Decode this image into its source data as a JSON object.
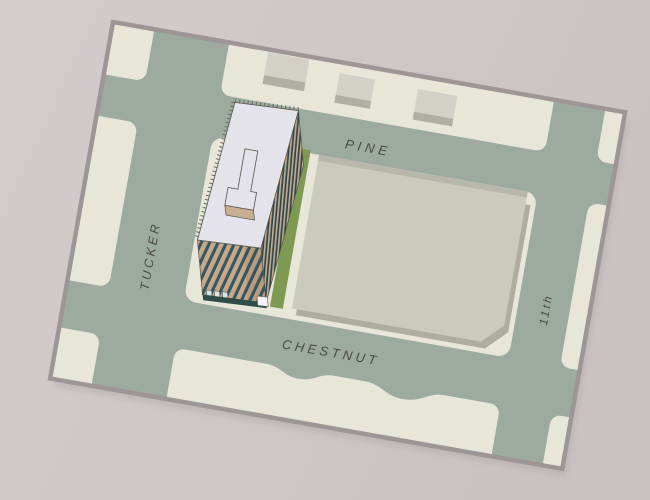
{
  "scene": {
    "kind": "architectural-site-plan",
    "rotation_deg": 10
  },
  "labels": {
    "pine": "PINE",
    "tucker": "TUCKER",
    "chestnut": "CHESTNUT",
    "eleventh": "11th"
  },
  "colors": {
    "background": "#cfc7c7",
    "site_border": "#9d9596",
    "site_shadow": "#b3a9a9",
    "street": "#9caa9f",
    "block": "#e8e6d9",
    "lot": "#cccabd",
    "lot_edge": "#b9b7ac",
    "lot_shadow": "#afada2",
    "small_building_roof": "#d3d1c7",
    "small_building_face": "#b1afa4",
    "grass": "#7e9a52",
    "tower_roof": "#e3e3e9",
    "outline": "#55544c",
    "hatch": "#6a6a60",
    "facade_tan": "#c4aa8d",
    "window_teal": "#39565c",
    "window_teal_dark": "#2b464c",
    "base_teal": "#2e4d49",
    "canopy_white": "#dde3e4",
    "box_white": "#f4f4f6",
    "penthouse_face": "#c8ae92",
    "facade_shade": "rgba(60,45,25,0.10)",
    "label_text": "#4b4b43"
  }
}
